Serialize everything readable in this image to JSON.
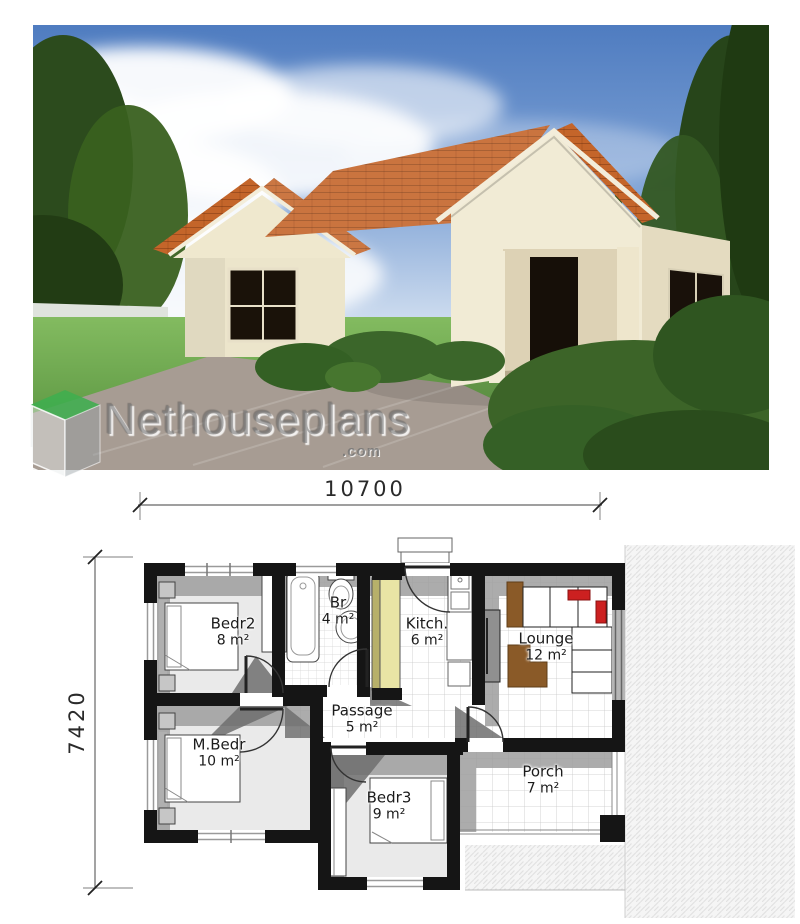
{
  "watermark": {
    "brand": "Nethouseplans",
    "suffix": ".com"
  },
  "plan": {
    "dimensions": {
      "width": "10700",
      "height": "7420"
    },
    "rooms": [
      {
        "name": "Bedr2",
        "area": "8 m²"
      },
      {
        "name": "Br",
        "area": "4 m²"
      },
      {
        "name": "Kitch.",
        "area": "6 m²"
      },
      {
        "name": "Lounge",
        "area": "12 m²"
      },
      {
        "name": "Passage",
        "area": "5 m²"
      },
      {
        "name": "M.Bedr",
        "area": "10 m²"
      },
      {
        "name": "Bedr3",
        "area": "9 m²"
      },
      {
        "name": "Porch",
        "area": "7 m²"
      }
    ]
  },
  "colors": {
    "wall_black": "#151515",
    "cupboard_yellow": "#e9e4a5",
    "sofa_cushion_red": "#cc2020",
    "furniture_brown": "#8a5a28",
    "roof_terracotta": "#c4652a",
    "logo_green": "#3fae4e",
    "sky_blue": "#4f7cc0",
    "lawn_green": "#5a9440"
  }
}
